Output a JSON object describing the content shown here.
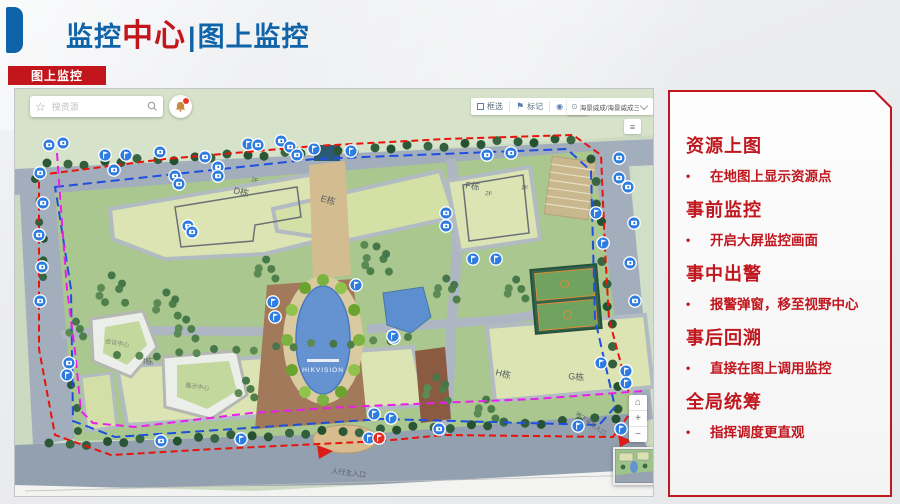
{
  "header": {
    "title_part1": "监控",
    "title_part2": "中心",
    "title_separator": "|",
    "title_part3": "图上监控",
    "accent_blue": "#0f63a8",
    "accent_red": "#c3161c"
  },
  "tab": {
    "label": "图上监控"
  },
  "map": {
    "search": {
      "placeholder": "搜资源",
      "star_icon": "☆"
    },
    "toolbar": {
      "box_select_label": "框选",
      "mark_label": "标记",
      "mark_icon": "⚑",
      "show_label": "显示",
      "show_icon": "◉"
    },
    "region_selector": {
      "pin_icon": "⊙",
      "value": "海景威成/海景威成三期园区"
    },
    "legend_icon": "≡",
    "zoom_controls": {
      "home_icon": "⌂",
      "zoom_in": "+",
      "zoom_out": "−"
    },
    "labels": {
      "building_d": "D栋",
      "building_e": "E栋",
      "building_f": "F栋",
      "building_g": "G栋",
      "building_h": "H栋",
      "building_i": "I栋",
      "floor_2f_d": "2F",
      "floor_2f_f": "2F",
      "floor_1f_f": "1F",
      "conference_center": "会议中心",
      "exhibition_center": "展示中心",
      "pond_logo": "HIKVISION",
      "entrance": "人行主入口",
      "garage": "地下车库入口"
    },
    "marker_colors": {
      "camera": "#2e7ce0",
      "alarm": "#e42b20"
    },
    "markers": [
      [
        34,
        56,
        "c"
      ],
      [
        48,
        54,
        "c"
      ],
      [
        90,
        66,
        "f"
      ],
      [
        111,
        66,
        "f"
      ],
      [
        145,
        63,
        "c"
      ],
      [
        190,
        68,
        "c"
      ],
      [
        233,
        55,
        "f"
      ],
      [
        243,
        56,
        "c"
      ],
      [
        266,
        52,
        "c"
      ],
      [
        275,
        58,
        "c"
      ],
      [
        282,
        66,
        "c"
      ],
      [
        299,
        60,
        "f"
      ],
      [
        336,
        62,
        "f"
      ],
      [
        472,
        66,
        "c"
      ],
      [
        496,
        64,
        "c"
      ],
      [
        604,
        69,
        "c"
      ],
      [
        604,
        89,
        "c"
      ],
      [
        25,
        84,
        "c"
      ],
      [
        28,
        114,
        "c"
      ],
      [
        24,
        146,
        "c"
      ],
      [
        27,
        178,
        "c"
      ],
      [
        25,
        212,
        "c"
      ],
      [
        54,
        274,
        "c"
      ],
      [
        52,
        286,
        "f"
      ],
      [
        99,
        81,
        "c"
      ],
      [
        160,
        87,
        "c"
      ],
      [
        164,
        95,
        "c"
      ],
      [
        203,
        78,
        "c"
      ],
      [
        203,
        87,
        "c"
      ],
      [
        173,
        137,
        "c"
      ],
      [
        177,
        143,
        "c"
      ],
      [
        258,
        213,
        "f"
      ],
      [
        260,
        228,
        "f"
      ],
      [
        341,
        196,
        "f"
      ],
      [
        379,
        249,
        "f"
      ],
      [
        431,
        124,
        "c"
      ],
      [
        431,
        137,
        "c"
      ],
      [
        458,
        170,
        "f"
      ],
      [
        481,
        170,
        "f"
      ],
      [
        581,
        124,
        "f"
      ],
      [
        588,
        154,
        "f"
      ],
      [
        613,
        98,
        "c"
      ],
      [
        619,
        134,
        "c"
      ],
      [
        615,
        174,
        "c"
      ],
      [
        620,
        212,
        "c"
      ],
      [
        611,
        282,
        "f"
      ],
      [
        611,
        294,
        "f"
      ],
      [
        378,
        247,
        "f"
      ],
      [
        586,
        274,
        "f"
      ],
      [
        424,
        340,
        "c"
      ],
      [
        563,
        337,
        "f"
      ],
      [
        606,
        340,
        "f"
      ],
      [
        359,
        325,
        "f"
      ],
      [
        376,
        329,
        "f"
      ],
      [
        146,
        352,
        "c"
      ],
      [
        226,
        350,
        "f"
      ],
      [
        354,
        349,
        "f"
      ],
      [
        364,
        349,
        "a"
      ]
    ]
  },
  "panel": {
    "border_color": "#c0161d",
    "bullet_char": "•",
    "sections": [
      {
        "heading": "资源上图",
        "bullet": "在地图上显示资源点"
      },
      {
        "heading": "事前监控",
        "bullet": "开启大屏监控画面"
      },
      {
        "heading": "事中出警",
        "bullet": "报警弹窗，移至视野中心"
      },
      {
        "heading": "事后回溯",
        "bullet": "直接在图上调用监控"
      },
      {
        "heading": "全局统筹",
        "bullet": "指挥调度更直观"
      }
    ]
  }
}
